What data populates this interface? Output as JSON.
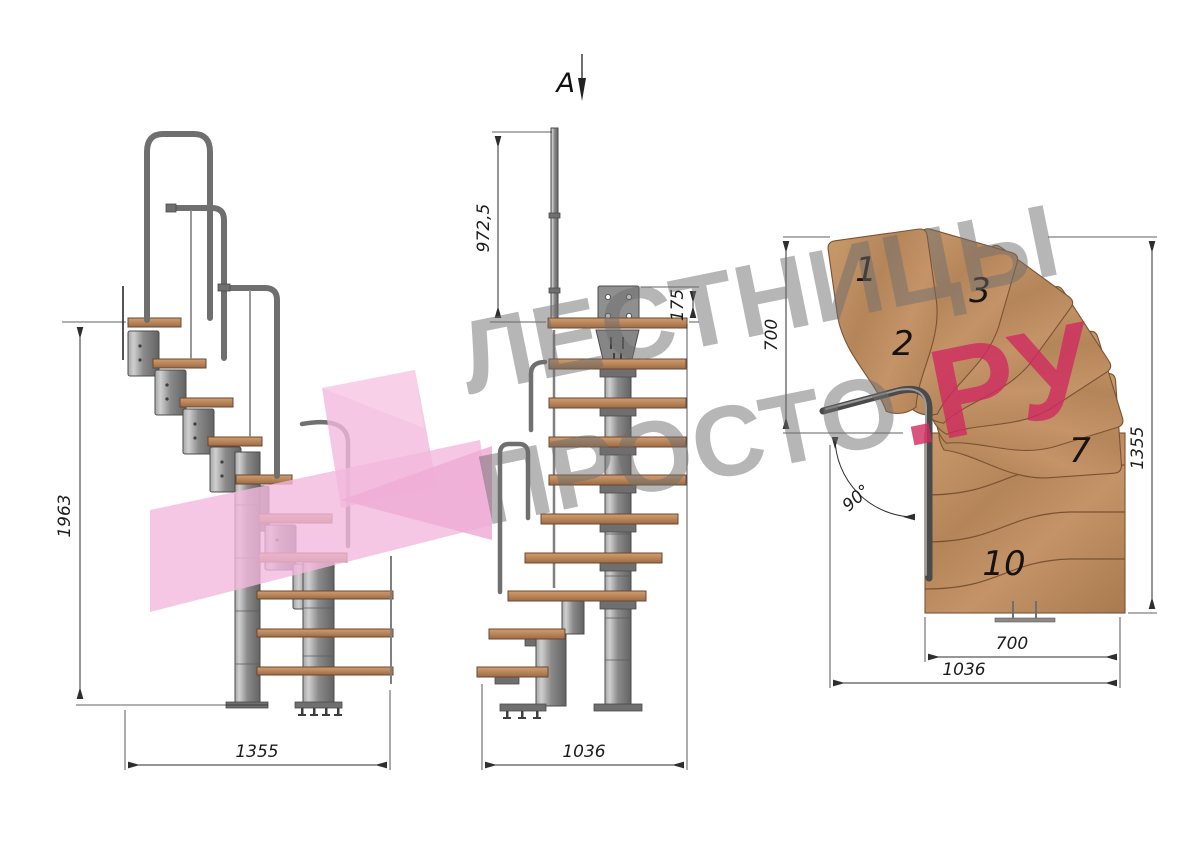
{
  "document": {
    "type": "staircase technical drawing",
    "background": "#ffffff"
  },
  "watermark": {
    "line1": "ЛЕСТНИЦЫ",
    "line2_main": "ПРОСТО",
    "line2_accent": ".РУ",
    "text_color": "#6e6e6e",
    "accent_color": "#d02b5f",
    "logo_shape_color": "#f2b9dd"
  },
  "section_marker": {
    "label": "A"
  },
  "views": {
    "side_elevation": {
      "name": "side elevation (left view)",
      "dims": {
        "total_height": "1963",
        "total_run": "1355"
      }
    },
    "front_elevation": {
      "name": "front elevation (middle view, section A)",
      "dims": {
        "rail_height": "972,5",
        "top_bracket_height": "175",
        "total_width": "1036"
      }
    },
    "plan": {
      "name": "top plan view",
      "dims": {
        "upper_run_depth": "700",
        "total_depth": "1355",
        "lower_run_width": "700",
        "total_width": "1036",
        "turn_angle": "90°"
      },
      "treads": [
        {
          "label": "1"
        },
        {
          "label": "2"
        },
        {
          "label": "3"
        },
        {
          "label": "7"
        },
        {
          "label": "10"
        }
      ]
    }
  },
  "colors": {
    "wood": "#b98a5e",
    "wood_dark": "#8a5d3b",
    "metal": "#7d7d7d",
    "metal_dark": "#4f4f4f",
    "dimension_lines": "#2e2e2e"
  }
}
